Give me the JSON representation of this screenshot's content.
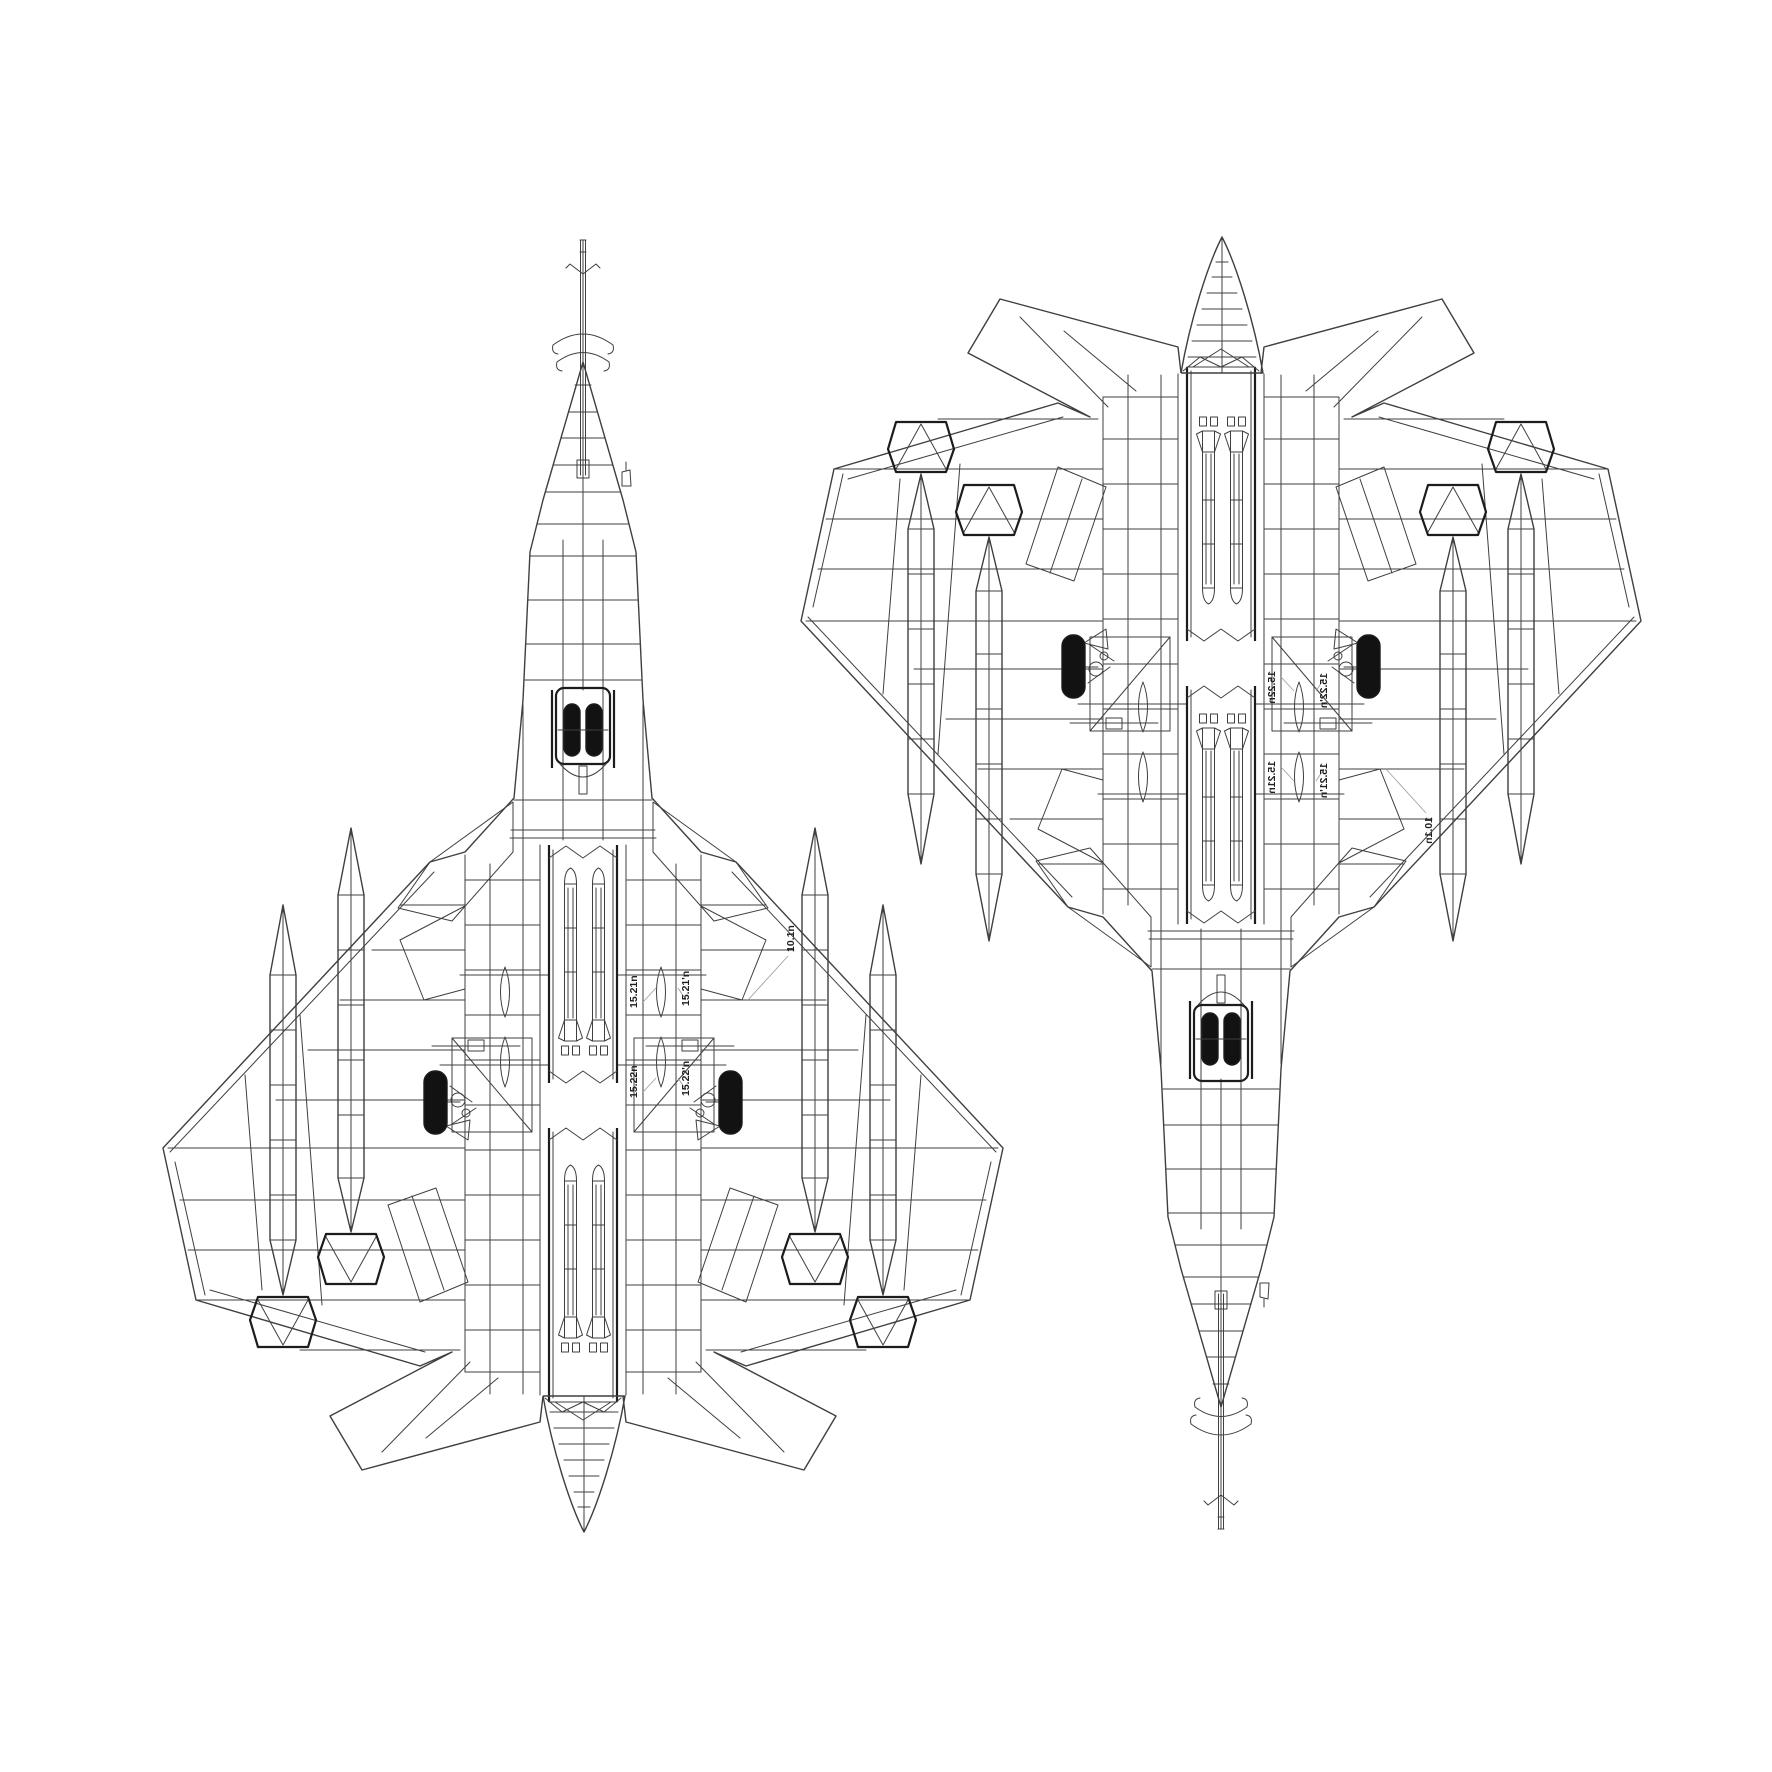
{
  "title": "Technical line drawing: twin bottom-plan views of a jet aircraft",
  "drawing": {
    "background": "#ffffff",
    "line_color": "#3f3f3f",
    "bold_line_color": "#1c1c1c",
    "wheel_black": "#121212"
  },
  "views": {
    "left": {
      "name": "bottom plan view, nose up"
    },
    "right": {
      "name": "bottom plan view, nose down (flipped copy)"
    }
  },
  "annotations": {
    "a1": "15.21n",
    "a2": "15.21'n",
    "a3": "15.22n",
    "a4": "15.22'n",
    "a5": "10.1n"
  }
}
